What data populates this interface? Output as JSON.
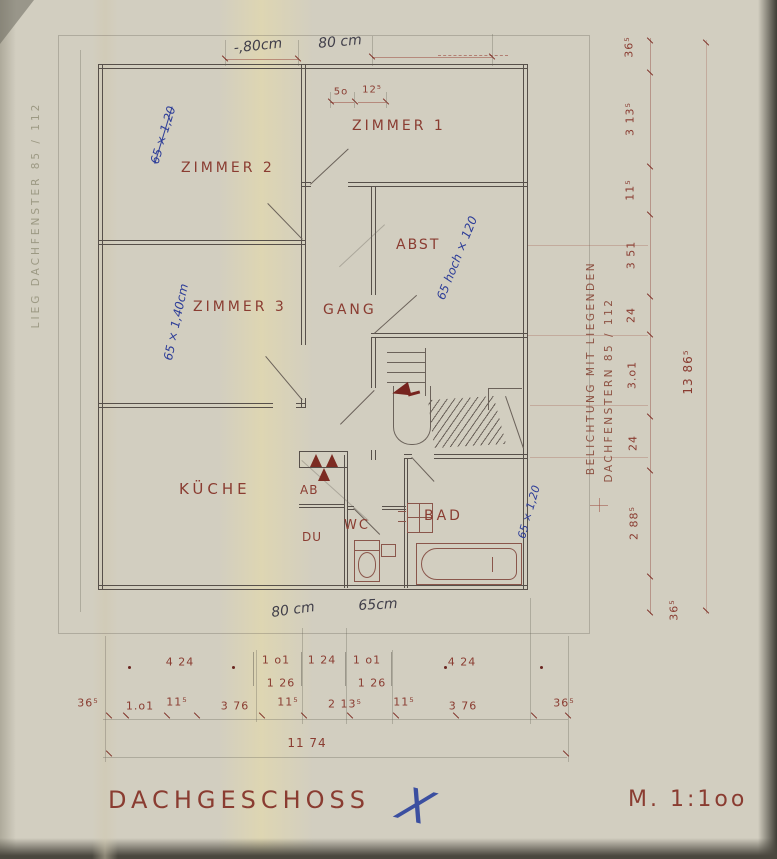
{
  "colors": {
    "paper": "#d2cec0",
    "ink": "#57504a",
    "print_red": "#8a3c31",
    "hand_blue": "#2d3d98",
    "hand_dark": "#413f4a",
    "fixture": "#8a564b",
    "arrow": "#77241f"
  },
  "title": {
    "name": "DACHGESCHOSS",
    "scale": "M. 1:1oo"
  },
  "rooms": {
    "zimmer1": "ZIMMER 1",
    "zimmer2": "ZIMMER 2",
    "zimmer3": "ZIMMER 3",
    "abst": "ABST",
    "gang": "GANG",
    "kueche": "KÜCHE",
    "ab": "AB",
    "du": "DU",
    "wc": "WC",
    "bad": "BAD"
  },
  "handwritten": {
    "top_a": "-,80cm",
    "top_b": "80 cm",
    "bottom_a": "80 cm",
    "bottom_b": "65cm",
    "zimmer2": "65 × 1,20",
    "zimmer3": "65 × 1,40cm",
    "abst": "65 hoch × 120",
    "bad": "65 × 1,20",
    "cross": "X"
  },
  "side_texts": {
    "left": "LIEG DACHFENSTER 85 / 112",
    "right_line1": "BELICHTUNG MIT LIEGENDEN",
    "right_line2": "DACHFENSTERN 85 / 112"
  },
  "dims": {
    "wall_a": "5o",
    "wall_b": "12⁵",
    "right_chain": [
      "36⁵",
      "3 13⁵",
      "11⁵",
      "3 51",
      "24",
      "3.o1",
      "24",
      "2 88⁵",
      "36⁵"
    ],
    "right_total": "13 86⁵",
    "bottom_row1": [
      "4 24",
      "1 o1",
      "1 24",
      "1 o1",
      "4 24"
    ],
    "bottom_row1_sub": [
      "1 26",
      "1 26"
    ],
    "bottom_row2": [
      "36⁵",
      "1.o1",
      "11⁵",
      "3 76",
      "11⁵",
      "2 13⁵",
      "11⁵",
      "3 76",
      "36⁵"
    ],
    "bottom_total": "11 74"
  }
}
